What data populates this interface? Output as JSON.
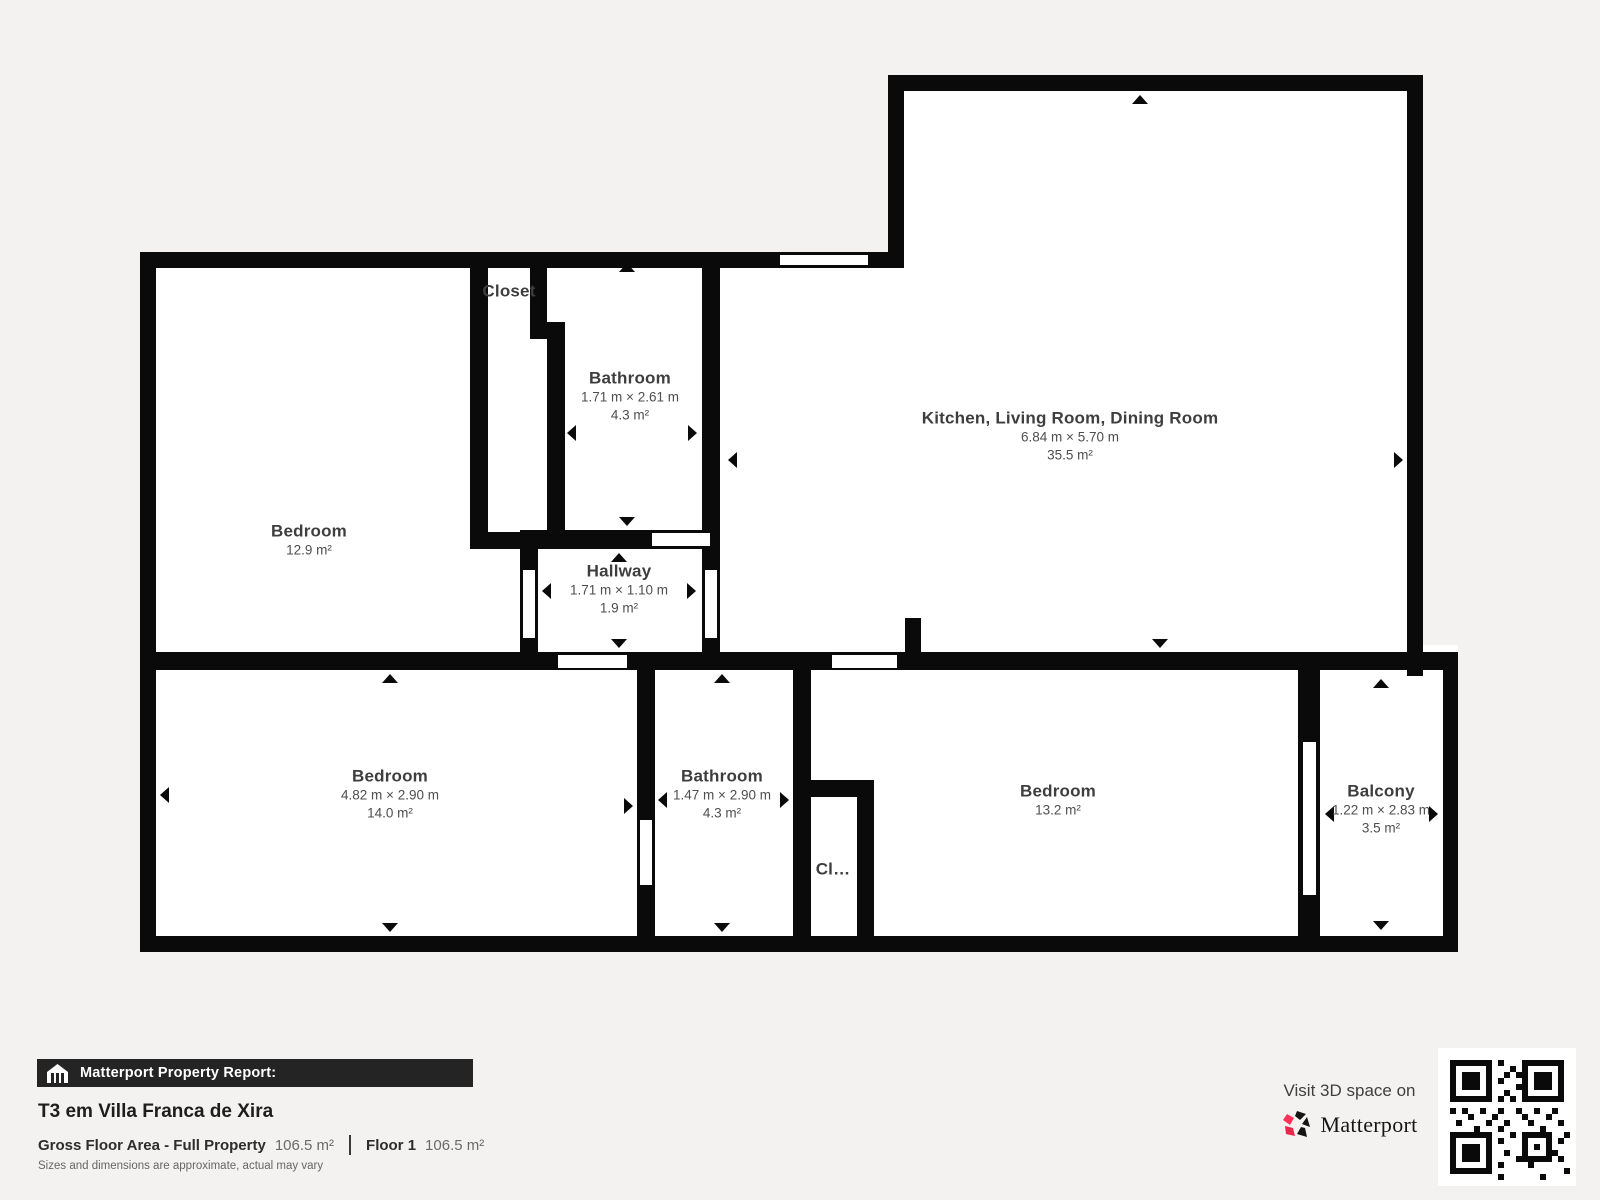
{
  "plan": {
    "rooms": [
      {
        "name": "Closet"
      },
      {
        "name": "Bathroom",
        "dims": "1.71 m × 2.61 m",
        "area": "4.3 m²"
      },
      {
        "name": "Kitchen, Living Room, Dining Room",
        "dims": "6.84 m × 5.70 m",
        "area": "35.5 m²"
      },
      {
        "name": "Bedroom",
        "area": "12.9 m²"
      },
      {
        "name": "Hallway",
        "dims": "1.71 m × 1.10 m",
        "area": "1.9 m²"
      },
      {
        "name": "Bedroom",
        "dims": "4.82 m × 2.90 m",
        "area": "14.0 m²"
      },
      {
        "name": "Bathroom",
        "dims": "1.47 m × 2.90 m",
        "area": "4.3 m²"
      },
      {
        "name": "Cl…"
      },
      {
        "name": "Bedroom",
        "area": "13.2 m²"
      },
      {
        "name": "Balcony",
        "dims": "1.22 m × 2.83 m",
        "area": "3.5 m²"
      }
    ]
  },
  "footer": {
    "report_label": "Matterport Property Report:",
    "property_title": "T3 em Villa Franca de Xira",
    "gross_label": "Gross Floor Area - Full Property",
    "gross_value": "106.5 m²",
    "floor_label": "Floor 1",
    "floor_value": "106.5 m²",
    "disclaimer": "Sizes and dimensions are approximate, actual may vary",
    "visit_text": "Visit 3D space on",
    "brand": "Matterport"
  },
  "icons": {
    "banner_icon": "house-icon",
    "brand_icon": "matterport-pinwheel-icon",
    "qr": "qr-code"
  },
  "colors": {
    "background": "#f3f2f0",
    "walls": "#0a0a0a",
    "room_fill": "#ffffff",
    "banner_bg": "#242424",
    "brand_pink": "#ff3158",
    "brand_red": "#e8274b",
    "room_text": "#4e4e4e"
  }
}
